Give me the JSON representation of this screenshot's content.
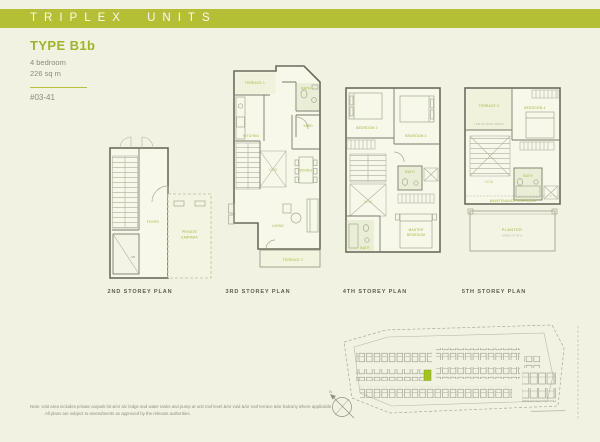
{
  "header": {
    "title": "TRIPLEX UNITS"
  },
  "unit_info": {
    "type": "TYPE B1b",
    "bedrooms": "4 bedroom",
    "area": "226 sq m",
    "unit_number": "#03-41"
  },
  "plans": {
    "storey2": {
      "caption": "2ND STOREY PLAN",
      "rooms": {
        "foyer": "FOYER",
        "carpark_line1": "PRIVATE",
        "carpark_line2": "CARPARK",
        "db": "DB"
      }
    },
    "storey3": {
      "caption": "3RD STOREY PLAN",
      "rooms": {
        "terrace1": "TERRACE 1",
        "bath": "BATH",
        "kitchen": "KITCHEN",
        "yard": "YARD",
        "void": "VOID",
        "dining": "DINING",
        "living": "LIVING",
        "terrace2": "TERRACE 2"
      }
    },
    "storey4": {
      "caption": "4TH STOREY PLAN",
      "rooms": {
        "bedroom2": "BEDROOM 2",
        "bedroom3": "BEDROOM 3",
        "bath_upper": "BATH",
        "void": "VOID",
        "bath_lower": "BATH",
        "master_line1": "MASTER",
        "master_line2": "BEDROOM"
      }
    },
    "storey5": {
      "caption": "5TH STOREY PLAN",
      "rooms": {
        "terrace3": "TERRACE 3",
        "bedroom4": "BEDROOM 4",
        "roof_note": "LINE OF ROOF ABOVE",
        "void": "VOID",
        "bath": "BATH",
        "maintenance": "MAINTENANCE CORRIDOR",
        "planter": "PLANTER",
        "planter_sub": "(OPEN TO SKY)"
      }
    }
  },
  "site_plan": {
    "north_label": "N",
    "highlighted_unit": "#03-41",
    "highlight_color": "#a3c31f"
  },
  "footnote": {
    "line1": "Note:  Unit area includes private carpark lot &/or a/c ledge and water tanks and pump at unit roof level &/or void &/or roof terrace &/or balcony where applicable.",
    "line2": "All plans are subject to amendments as approved by the relevant authorities."
  },
  "colors": {
    "accent_band": "#b5bf35",
    "title_green": "#9fb42c",
    "label_green": "#a6b233",
    "text_gray": "#8c8c7c"
  }
}
